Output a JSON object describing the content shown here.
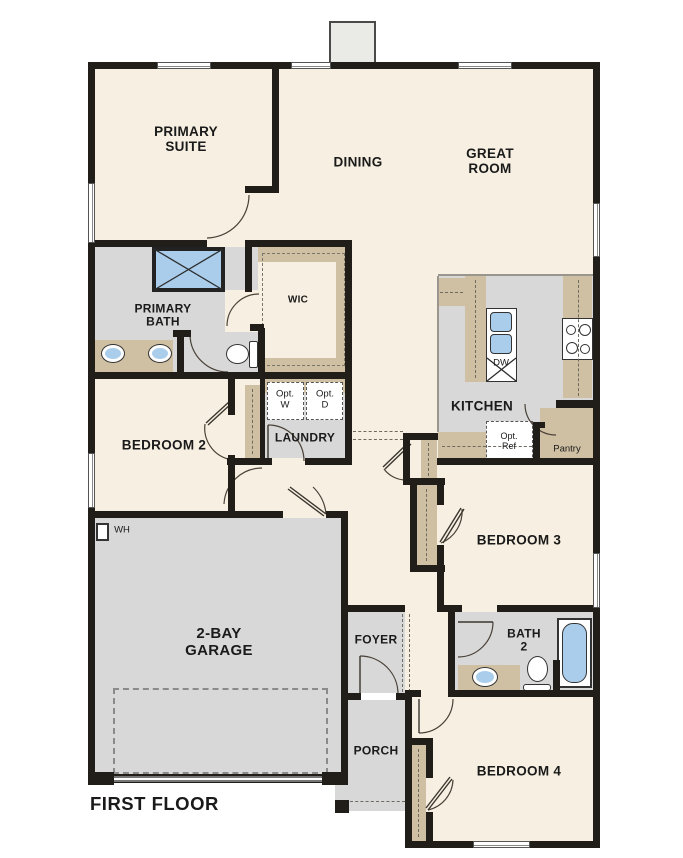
{
  "plan": {
    "floor_title": "FIRST FLOOR",
    "rooms": {
      "primary_suite": "PRIMARY\nSUITE",
      "dining": "DINING",
      "great_room": "GREAT\nROOM",
      "primary_bath": "PRIMARY\nBATH",
      "wic": "WIC",
      "bedroom_2": "BEDROOM 2",
      "laundry": "LAUNDRY",
      "kitchen": "KITCHEN",
      "pantry": "Pantry",
      "bedroom_3": "BEDROOM 3",
      "garage": "2-BAY\nGARAGE",
      "foyer": "FOYER",
      "bath_2": "BATH\n2",
      "porch": "PORCH",
      "bedroom_4": "BEDROOM 4"
    },
    "fixtures": {
      "opt_washer": "Opt.\nW",
      "opt_dryer": "Opt.\nD",
      "dishwasher": "DW",
      "opt_refrigerator": "Opt.\nRef",
      "water_heater": "WH"
    },
    "colors": {
      "wall": "#211e1a",
      "room_floor": "#f7f0e2",
      "hard_floor": "#d8d8d8",
      "cabinet_tan": "#cfc0a3",
      "fixture_blue": "#a9cdeb",
      "chimney_gray": "#eaeae7"
    }
  }
}
